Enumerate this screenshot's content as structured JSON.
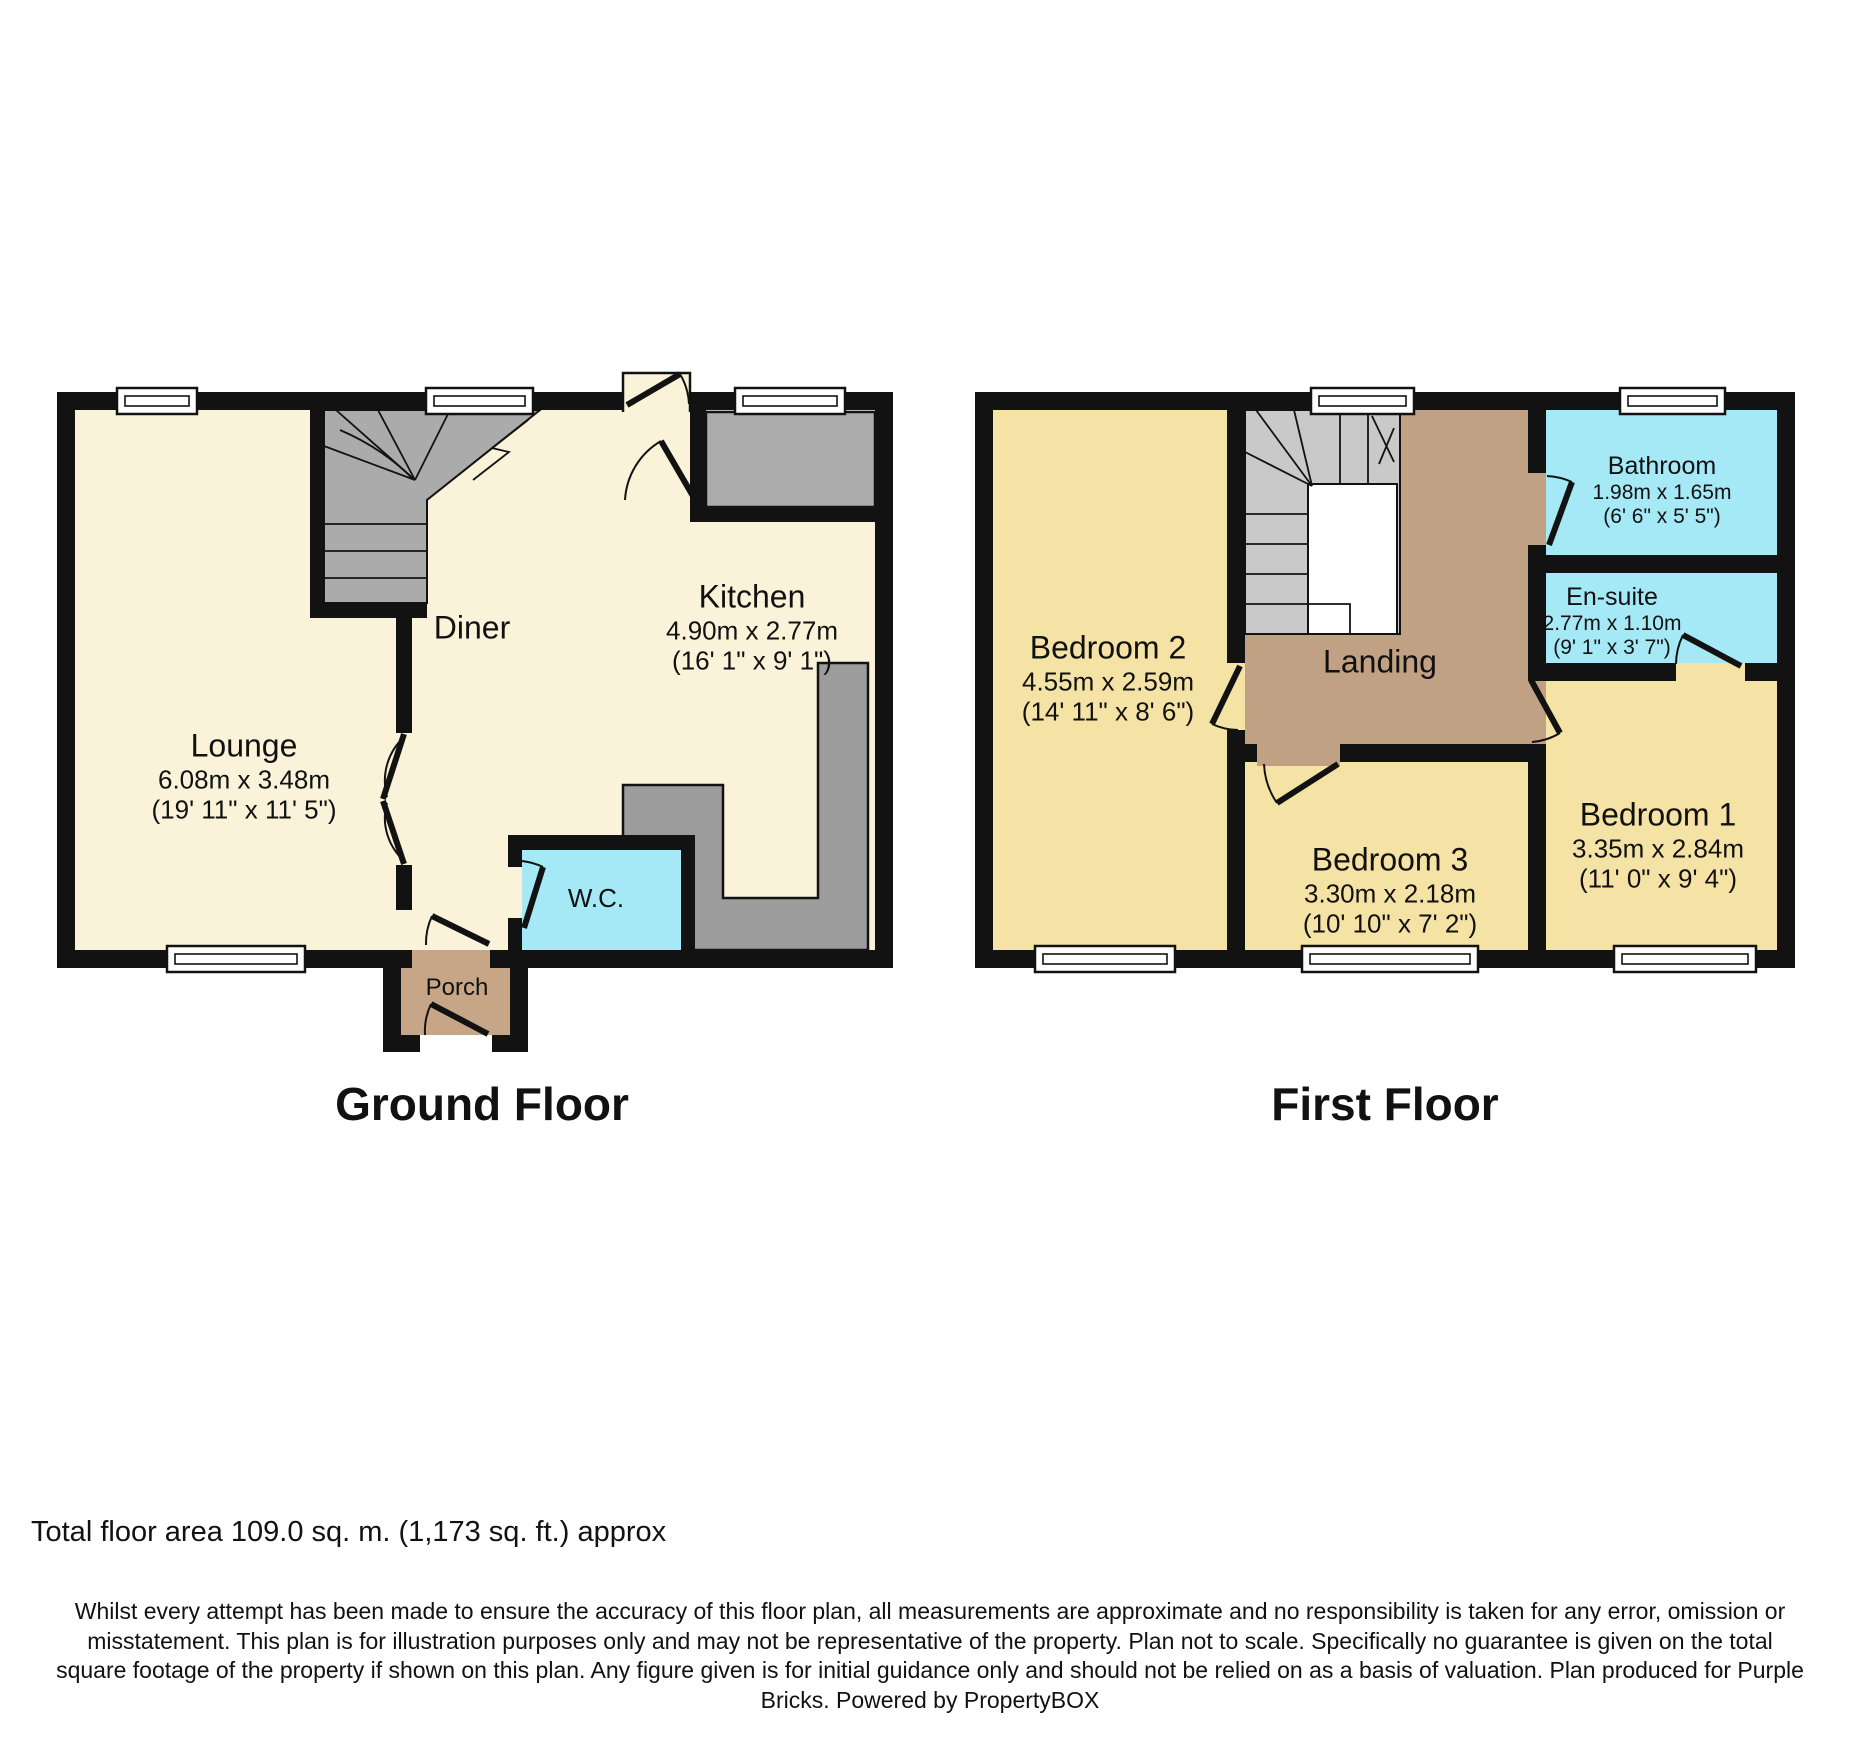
{
  "ground_floor": {
    "title": "Ground Floor",
    "rooms": {
      "lounge": {
        "name": "Lounge",
        "metric": "6.08m x 3.48m",
        "imperial": "(19' 11\" x 11' 5\")"
      },
      "diner": {
        "name": "Diner"
      },
      "kitchen": {
        "name": "Kitchen",
        "metric": "4.90m x 2.77m",
        "imperial": "(16' 1\" x 9' 1\")"
      },
      "wc": {
        "name": "W.C."
      },
      "porch": {
        "name": "Porch"
      }
    }
  },
  "first_floor": {
    "title": "First Floor",
    "rooms": {
      "bedroom2": {
        "name": "Bedroom 2",
        "metric": "4.55m x 2.59m",
        "imperial": "(14' 11\" x 8' 6\")"
      },
      "bedroom3": {
        "name": "Bedroom 3",
        "metric": "3.30m x 2.18m",
        "imperial": "(10' 10\" x 7' 2\")"
      },
      "bedroom1": {
        "name": "Bedroom 1",
        "metric": "3.35m x 2.84m",
        "imperial": "(11' 0\" x 9' 4\")"
      },
      "bathroom": {
        "name": "Bathroom",
        "metric": "1.98m x 1.65m",
        "imperial": "(6' 6\" x 5' 5\")"
      },
      "ensuite": {
        "name": "En-suite",
        "metric": "2.77m x 1.10m",
        "imperial": "(9' 1\" x 3' 7\")"
      },
      "landing": {
        "name": "Landing"
      }
    }
  },
  "footer": {
    "total_area": "Total floor area 109.0 sq. m. (1,173 sq. ft.) approx",
    "disclaimer_lines": [
      "Whilst every attempt has been made to ensure the accuracy of this floor plan, all measurements are approximate and no responsibility is taken for any error, omission or",
      "misstatement. This plan is for illustration purposes only and may not be representative of the property. Plan not to scale. Specifically no guarantee is given on the total",
      "square footage of the property if shown on this plan. Any figure given is for initial guidance only and should not be relied on as a basis of valuation.  Plan produced for Purple",
      "Bricks. Powered by PropertyBOX"
    ]
  },
  "colors": {
    "wall": "#121212",
    "cream": "#faf3da",
    "yellow": "#f5e3a6",
    "tan": "#c1a183",
    "porch": "#c6a686",
    "cyan": "#a5e8f6",
    "stair": "#ababab",
    "stair_light": "#c9c9c9",
    "unit": "#acacac",
    "unit_dark": "#9c9c9c"
  }
}
